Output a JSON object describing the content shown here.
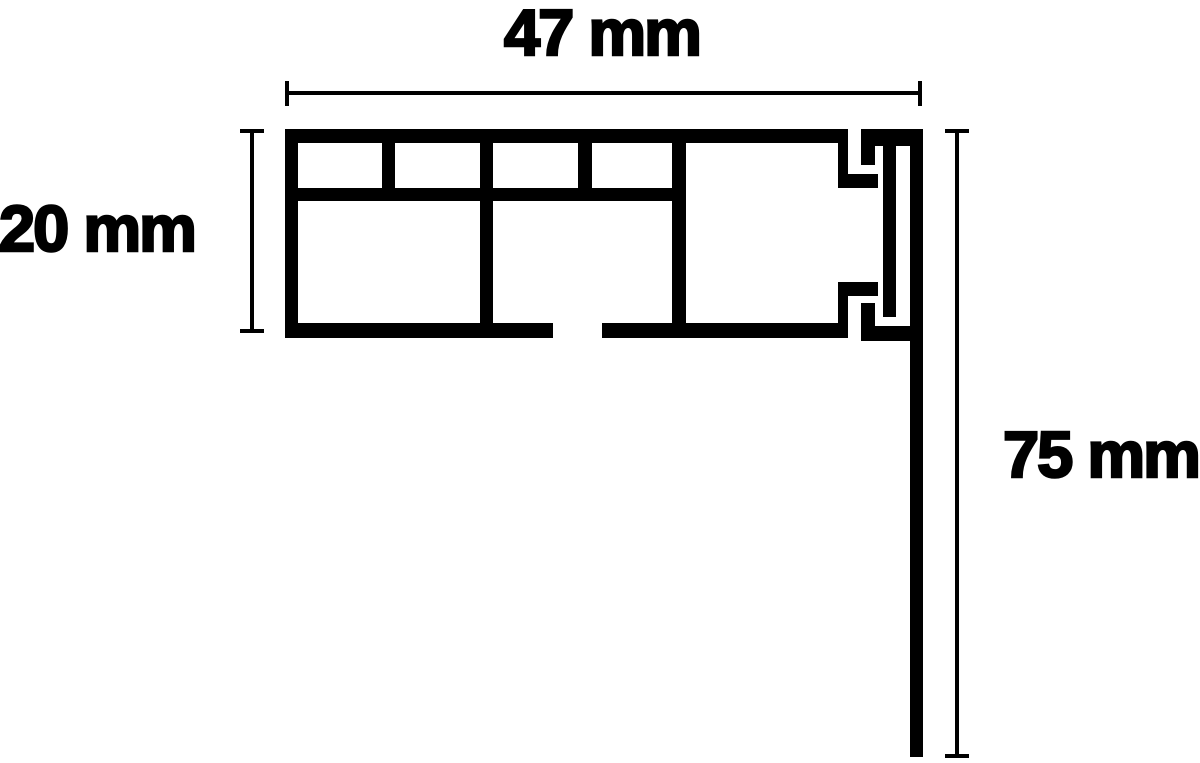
{
  "diagram": {
    "title": "profile cross-section dimension drawing",
    "labels": {
      "width": "47 mm",
      "height": "20 mm",
      "drop": "75 mm"
    },
    "colors": {
      "ink": "#000000",
      "background": "#ffffff"
    }
  }
}
